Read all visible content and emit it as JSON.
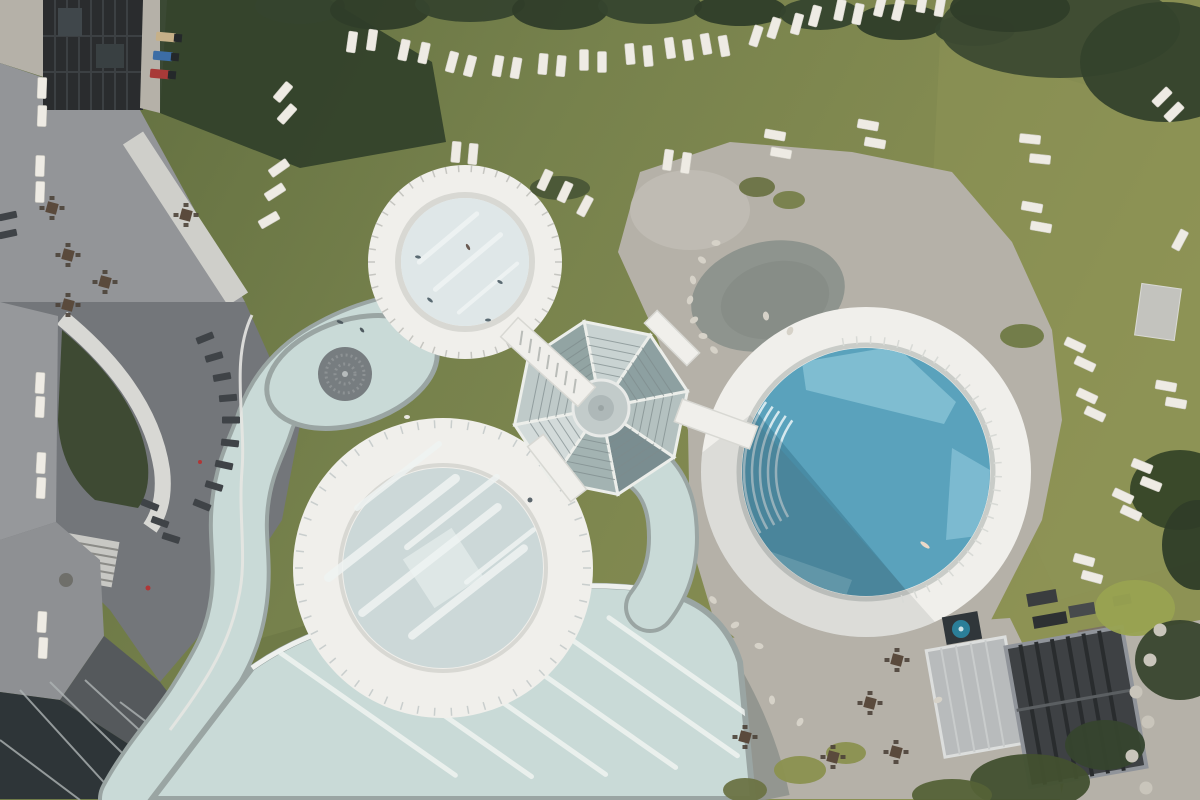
{
  "meta": {
    "description": "Aerial top-down photograph of a thermal spa resort with three circular pools, a lazy river, a glass pavilion, lawns with white sun loungers, gravel terraces and hotel buildings",
    "width": 1200,
    "height": 800
  },
  "colors": {
    "grass_dark": "#5f6c3e",
    "grass_mid": "#76814c",
    "grass_sunny": "#8d9254",
    "grass_overlay": "#8e9355",
    "grass_wedge": "#6f7a47",
    "shadow_grass": "#31402a",
    "water_pale": "#c9dad7",
    "water_pale_light": "#dfe7e8",
    "water_border": "#9aa5a3",
    "wave_water": "#ccd8d8",
    "wave_square": "#e0e9e8",
    "blue_deep": "#5aa2bc",
    "blue_light": "#7fbdd1",
    "blue_shadow": "#235a70",
    "rim_white": "#f0efeb",
    "rim_shade": "#d8d8d3",
    "gravel": "#b5b1a8",
    "gravel_light": "#c2beb5",
    "pond_wet": "#8e948e",
    "stone_terrace": "#939598",
    "plaza": "#73767a",
    "roof_dark": "#2a2c2e",
    "roof_side": "#96989b",
    "roof_side_b": "#8e9093",
    "dark_strip": "#55595c",
    "glass_roof": "#2e3538",
    "garden_dark": "#3e4a33",
    "band_white": "#d8d8d4",
    "lounger_white": "#eeebe4",
    "lounger_dark": "#3f4347",
    "table_dark": "#5a4a3c",
    "rock": "#d6d2c8",
    "stairs": "#c8c8c4",
    "whirlpool": "#777d80",
    "roof_big_dark": "#3e4144",
    "roof_light": "#b8bbbc",
    "tub_teal": "#2b7f99",
    "pavilion_hub": "#c2cbca",
    "lane_white": "#eef2f0",
    "path_white": "#cfcfca"
  },
  "pavilion": {
    "cx": 601,
    "cy": 408,
    "outer_r": 88,
    "hub_r": 28,
    "start_angle": -11,
    "sector_tints": [
      "#b4c1c0",
      "#7a8d90",
      "#a3b3b2",
      "#d3dbda",
      "#bfcac9",
      "#92a4a3",
      "#c9d3d2",
      "#8da0a1"
    ]
  },
  "pools": {
    "small": {
      "cx": 465,
      "cy": 262,
      "outer_r": 97,
      "water_r": 64
    },
    "wave": {
      "cx": 443,
      "cy": 568,
      "outer_r": 150,
      "water_r": 100,
      "square": 58
    },
    "blue": {
      "cx": 866,
      "cy": 472,
      "outer_r": 165,
      "water_r": 124
    },
    "whirlpool": {
      "cx": 345,
      "cy": 374,
      "r": 27
    }
  },
  "bridges": [
    [
      548,
      362,
      104,
      26,
      42
    ],
    [
      716,
      424,
      80,
      24,
      20
    ],
    [
      557,
      468,
      70,
      20,
      52
    ],
    [
      672,
      338,
      60,
      18,
      45
    ]
  ],
  "step_arc_radii": [
    90,
    98,
    106,
    114,
    122
  ],
  "wave_streaks": [
    [
      392,
      528,
      170,
      9
    ],
    [
      430,
      560,
      180,
      8
    ],
    [
      468,
      592,
      150,
      8
    ],
    [
      452,
      512,
      120,
      6
    ],
    [
      398,
      476,
      110,
      6
    ],
    [
      500,
      556,
      90,
      5
    ]
  ],
  "small_streaks": [
    [
      448,
      238,
      80,
      5
    ],
    [
      468,
      262,
      90,
      5
    ],
    [
      488,
      288,
      80,
      4
    ]
  ],
  "lap_lanes": [
    [
      355,
      705,
      250
    ],
    [
      425,
      702,
      265
    ],
    [
      495,
      697,
      275
    ],
    [
      565,
      690,
      275
    ],
    [
      635,
      684,
      255
    ],
    [
      695,
      678,
      215
    ]
  ],
  "loungers_white": [
    [
      352,
      42,
      8
    ],
    [
      372,
      40,
      8
    ],
    [
      404,
      50,
      12
    ],
    [
      424,
      53,
      12
    ],
    [
      452,
      62,
      15
    ],
    [
      470,
      66,
      15
    ],
    [
      498,
      66,
      10
    ],
    [
      516,
      68,
      10
    ],
    [
      543,
      64,
      5
    ],
    [
      561,
      66,
      5
    ],
    [
      584,
      60,
      0
    ],
    [
      602,
      62,
      0
    ],
    [
      630,
      54,
      -5
    ],
    [
      648,
      56,
      -5
    ],
    [
      670,
      48,
      -8
    ],
    [
      688,
      50,
      -8
    ],
    [
      706,
      44,
      -10
    ],
    [
      724,
      46,
      -10
    ],
    [
      756,
      36,
      18
    ],
    [
      774,
      28,
      18
    ],
    [
      797,
      24,
      15
    ],
    [
      815,
      16,
      15
    ],
    [
      840,
      10,
      12
    ],
    [
      858,
      14,
      12
    ],
    [
      880,
      6,
      14
    ],
    [
      898,
      10,
      14
    ],
    [
      922,
      2,
      10
    ],
    [
      940,
      6,
      10
    ],
    [
      283,
      92,
      40
    ],
    [
      287,
      114,
      42
    ],
    [
      279,
      168,
      55
    ],
    [
      275,
      192,
      57
    ],
    [
      269,
      220,
      60
    ],
    [
      775,
      135,
      100
    ],
    [
      781,
      153,
      100
    ],
    [
      868,
      125,
      100
    ],
    [
      875,
      143,
      100
    ],
    [
      1030,
      139,
      96
    ],
    [
      1040,
      159,
      96
    ],
    [
      1162,
      97,
      45
    ],
    [
      1174,
      112,
      45
    ],
    [
      1032,
      207,
      100
    ],
    [
      1041,
      227,
      100
    ],
    [
      1180,
      240,
      28
    ],
    [
      545,
      180,
      25
    ],
    [
      565,
      192,
      25
    ],
    [
      585,
      206,
      28
    ],
    [
      456,
      152,
      5
    ],
    [
      473,
      154,
      5
    ],
    [
      668,
      160,
      8
    ],
    [
      686,
      163,
      8
    ],
    [
      1075,
      345,
      115
    ],
    [
      1085,
      364,
      115
    ],
    [
      1087,
      396,
      115
    ],
    [
      1095,
      414,
      115
    ],
    [
      1166,
      386,
      100
    ],
    [
      1176,
      403,
      100
    ],
    [
      1142,
      466,
      112
    ],
    [
      1151,
      484,
      112
    ],
    [
      1123,
      496,
      115
    ],
    [
      1131,
      513,
      115
    ],
    [
      1084,
      560,
      105
    ],
    [
      1092,
      577,
      105
    ],
    [
      42,
      88,
      2
    ],
    [
      42,
      116,
      2
    ],
    [
      40,
      166,
      2
    ],
    [
      40,
      192,
      2
    ],
    [
      40,
      383,
      3
    ],
    [
      40,
      407,
      3
    ],
    [
      41,
      463,
      3
    ],
    [
      41,
      488,
      3
    ],
    [
      42,
      622,
      3
    ],
    [
      43,
      648,
      3
    ]
  ],
  "loungers_dark": [
    [
      205,
      338,
      68
    ],
    [
      214,
      357,
      74
    ],
    [
      222,
      377,
      80
    ],
    [
      228,
      398,
      85
    ],
    [
      231,
      420,
      90
    ],
    [
      230,
      443,
      96
    ],
    [
      224,
      465,
      102
    ],
    [
      214,
      486,
      107
    ],
    [
      202,
      505,
      112
    ],
    [
      150,
      505,
      112
    ],
    [
      160,
      522,
      110
    ],
    [
      171,
      538,
      108
    ],
    [
      8,
      216,
      78
    ],
    [
      8,
      234,
      78
    ]
  ],
  "loungers_colored": [
    {
      "x": 166,
      "y": 37,
      "rot": 95,
      "c": "#c6b088"
    },
    {
      "x": 163,
      "y": 56,
      "rot": 95,
      "c": "#3c6da5"
    },
    {
      "x": 160,
      "y": 74,
      "rot": 95,
      "c": "#a83a38"
    }
  ],
  "tables": [
    [
      52,
      208
    ],
    [
      68,
      255
    ],
    [
      105,
      282
    ],
    [
      186,
      215
    ],
    [
      68,
      305
    ],
    [
      897,
      660
    ],
    [
      870,
      703
    ],
    [
      833,
      757
    ],
    [
      896,
      752
    ],
    [
      745,
      737
    ]
  ],
  "bushes": [
    [
      300,
      6,
      45,
      18,
      "#36452e"
    ],
    [
      380,
      10,
      50,
      20,
      "#2f3d29"
    ],
    [
      470,
      4,
      55,
      18,
      "#36452e"
    ],
    [
      560,
      10,
      48,
      20,
      "#2f3d29"
    ],
    [
      650,
      6,
      52,
      18,
      "#36452e"
    ],
    [
      740,
      10,
      46,
      16,
      "#2f3d29"
    ],
    [
      820,
      14,
      40,
      16,
      "#36452e"
    ],
    [
      900,
      22,
      44,
      18,
      "#2f3d29"
    ],
    [
      975,
      30,
      40,
      16,
      "#36452e"
    ],
    [
      1060,
      28,
      120,
      50,
      "#3c4a31"
    ],
    [
      1165,
      62,
      85,
      60,
      "#34422c"
    ],
    [
      1010,
      8,
      60,
      24,
      "#2f3d29"
    ],
    [
      560,
      188,
      30,
      12,
      "#4a5637"
    ],
    [
      757,
      187,
      18,
      10,
      "#6b7345"
    ],
    [
      789,
      200,
      16,
      9,
      "#77804a"
    ],
    [
      1022,
      336,
      22,
      12,
      "#707a44"
    ],
    [
      1180,
      490,
      50,
      40,
      "#364428"
    ],
    [
      1197,
      545,
      35,
      45,
      "#2f3d28"
    ],
    [
      1135,
      608,
      40,
      28,
      "#99a351"
    ],
    [
      1180,
      660,
      45,
      40,
      "#39462e"
    ],
    [
      1030,
      782,
      60,
      28,
      "#42502f"
    ],
    [
      952,
      795,
      40,
      16,
      "#556237"
    ],
    [
      800,
      770,
      26,
      14,
      "#8b914f"
    ],
    [
      846,
      753,
      20,
      11,
      "#8b914f"
    ],
    [
      745,
      790,
      22,
      12,
      "#6b7345"
    ],
    [
      1105,
      745,
      40,
      25,
      "#36452e"
    ]
  ],
  "rocks": [
    [
      716,
      243
    ],
    [
      702,
      260
    ],
    [
      693,
      280
    ],
    [
      690,
      300
    ],
    [
      694,
      320
    ],
    [
      703,
      336
    ],
    [
      714,
      350
    ],
    [
      766,
      316
    ],
    [
      790,
      331
    ],
    [
      735,
      625
    ],
    [
      759,
      646
    ],
    [
      713,
      600
    ],
    [
      772,
      700
    ],
    [
      800,
      722
    ],
    [
      938,
      700
    ]
  ],
  "stepping_stones": [
    [
      1150,
      660
    ],
    [
      1136,
      692
    ],
    [
      1148,
      722
    ],
    [
      1132,
      756
    ],
    [
      1146,
      788
    ],
    [
      1160,
      630
    ]
  ],
  "people": [
    [
      430,
      300,
      40,
      "#5a6a72",
      7,
      3
    ],
    [
      418,
      257,
      10,
      "#5a6a72",
      6,
      3
    ],
    [
      468,
      247,
      60,
      "#6a5a52",
      7,
      3
    ],
    [
      500,
      282,
      30,
      "#5a6a72",
      6,
      3
    ],
    [
      488,
      320,
      0,
      "#5a6a72",
      6,
      3
    ],
    [
      340,
      322,
      20,
      "#4f5a60",
      7,
      3
    ],
    [
      362,
      330,
      50,
      "#4f5a60",
      6,
      3
    ],
    [
      407,
      417,
      0,
      "#e9e7e1",
      6,
      4
    ],
    [
      148,
      588,
      0,
      "#b03636",
      5,
      5
    ],
    [
      200,
      462,
      0,
      "#b03636",
      4,
      4
    ],
    [
      925,
      545,
      35,
      "#ead9c8",
      11,
      4
    ],
    [
      530,
      500,
      0,
      "#5c666c",
      5,
      5
    ]
  ],
  "roof_equipment": [
    [
      1042,
      598,
      30,
      13,
      -10,
      "#3a3d3f"
    ],
    [
      1050,
      620,
      34,
      12,
      -10,
      "#2d3032"
    ],
    [
      1082,
      610,
      26,
      12,
      -10,
      "#474a4c"
    ],
    [
      1094,
      638,
      30,
      20,
      -10,
      "#7b7166"
    ],
    [
      1122,
      600,
      18,
      10,
      -10,
      "#3a3d3f"
    ]
  ],
  "ticks": {
    "small": [
      465,
      262,
      90,
      97,
      46,
      "#c6c6c1"
    ],
    "wave": [
      443,
      568,
      140,
      148,
      54,
      "#c9cecd"
    ],
    "blue": [
      866,
      472,
      128,
      136,
      30,
      "#d8dad6"
    ]
  }
}
